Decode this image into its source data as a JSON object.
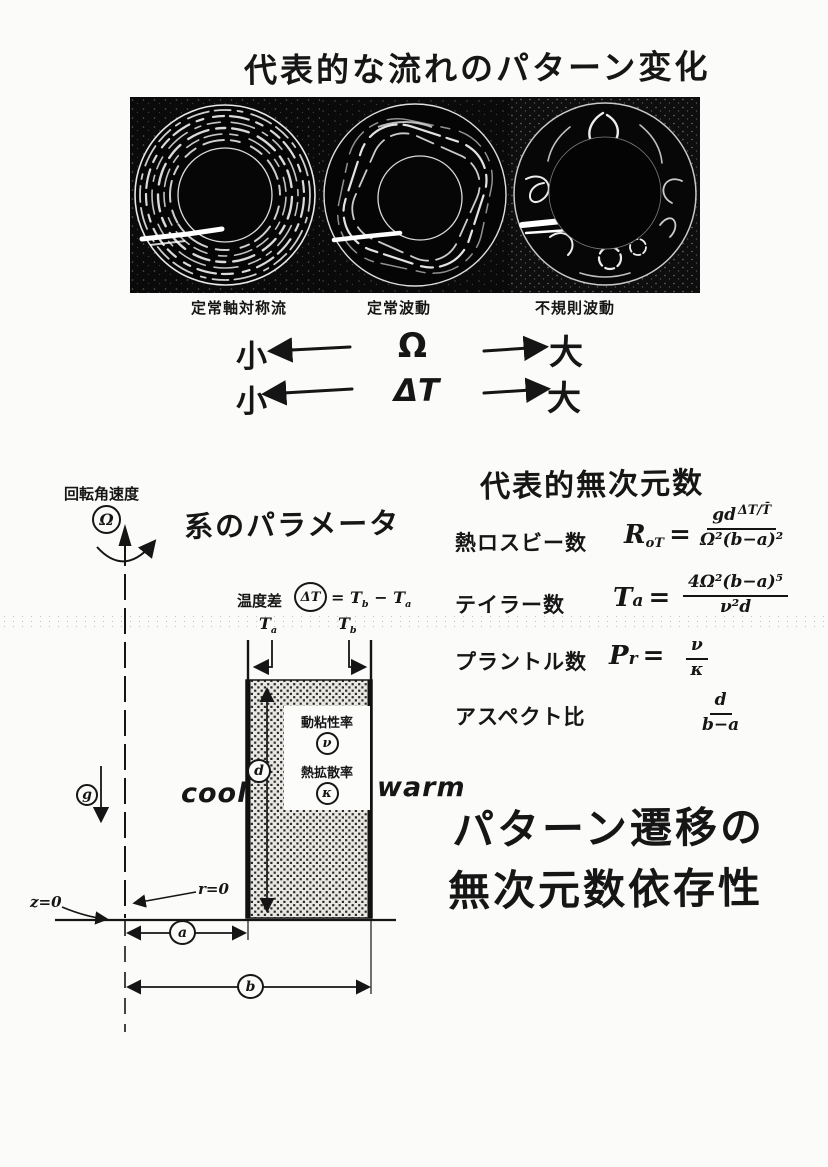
{
  "page": {
    "title": "代表的な流れのパターン変化"
  },
  "photos": {
    "captions": [
      "定常軸対称流",
      "定常波動",
      "不規則波動"
    ]
  },
  "scale_rows": [
    {
      "small": "小",
      "symbol": "Ω",
      "large": "大"
    },
    {
      "small": "小",
      "symbol": "ΔT",
      "large": "大"
    }
  ],
  "diagram": {
    "rotation_label": "回転角速度",
    "omega": "Ω",
    "heading": "系のパラメータ",
    "temp_label": "温度差",
    "delta_t": "ΔT",
    "temp_eq": {
      "equals": "=",
      "t": "T",
      "sub_b": "b",
      "minus": "−",
      "sub_a": "a"
    },
    "t_inner": {
      "base": "T",
      "sub": "a"
    },
    "t_outer": {
      "base": "T",
      "sub": "b"
    },
    "viscosity_label": "動粘性率",
    "nu": "ν",
    "diffusivity_label": "熱拡散率",
    "kappa": "κ",
    "cool": "cool",
    "warm": "warm",
    "gravity": "g",
    "depth": "d",
    "z0": "z=0",
    "r0": "r=0",
    "radius_inner": "a",
    "radius_outer": "b"
  },
  "dimensionless": {
    "heading": "代表的無次元数",
    "rossby": {
      "label": "熱ロスビー数",
      "symbol_base": "R",
      "symbol_sub": "oT",
      "equals": "=",
      "num_main": "gd",
      "num_sup": "ΔT/T̄",
      "den": "Ω²(b−a)²"
    },
    "taylor": {
      "label": "テイラー数",
      "symbol_base": "T",
      "symbol_sub": "a",
      "equals": "=",
      "num": "4Ω²(b−a)⁵",
      "den": "ν²d"
    },
    "prandtl": {
      "label": "プラントル数",
      "symbol_base": "P",
      "symbol_sub": "r",
      "equals": "=",
      "num": "ν",
      "den": "κ"
    },
    "aspect": {
      "label": "アスペクト比",
      "num": "d",
      "den": "b−a"
    }
  },
  "footer": {
    "line1": "パターン遷移の",
    "line2": "無次元数依存性"
  }
}
